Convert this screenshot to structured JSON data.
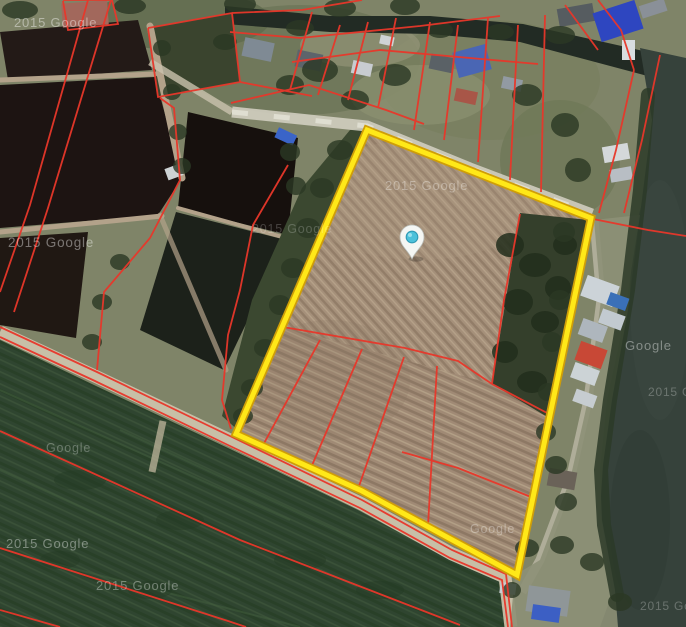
{
  "map": {
    "description": "satellite-map-with-parcel-overlay",
    "provider_watermarks": [
      {
        "text": "2015 Google",
        "x": 14,
        "y": 27,
        "size": 13,
        "opacity": 0.42
      },
      {
        "text": "2015 Google",
        "x": 8,
        "y": 247,
        "size": 13.5,
        "opacity": 0.4
      },
      {
        "text": "2015 Google",
        "x": 252,
        "y": 233,
        "size": 12.5,
        "opacity": 0.2
      },
      {
        "text": "2015 Google",
        "x": 385,
        "y": 190,
        "size": 13,
        "opacity": 0.32
      },
      {
        "text": "Google",
        "x": 625,
        "y": 350,
        "size": 13,
        "opacity": 0.38
      },
      {
        "text": "Google",
        "x": 46,
        "y": 452,
        "size": 12.5,
        "opacity": 0.28
      },
      {
        "text": "2015 Google",
        "x": 6,
        "y": 548,
        "size": 13,
        "opacity": 0.38
      },
      {
        "text": "2015 Google",
        "x": 96,
        "y": 590,
        "size": 13,
        "opacity": 0.34
      },
      {
        "text": "Google",
        "x": 470,
        "y": 533,
        "size": 12.5,
        "opacity": 0.3
      },
      {
        "text": "2015 Goo",
        "x": 648,
        "y": 396,
        "size": 12,
        "opacity": 0.25
      },
      {
        "text": "2015 Google",
        "x": 640,
        "y": 610,
        "size": 12,
        "opacity": 0.25
      }
    ],
    "pin": {
      "x": 412,
      "y": 259,
      "balloon_color": "#f4f6f3",
      "dot_color": "#4cc1da"
    },
    "highlight_parcel": {
      "points": "367,130 591,218 549,420 517,575 362,491 236,434",
      "core_color": "#ffe818",
      "edge_color": "#cf9e08",
      "core_width": 5,
      "edge_width": 8.5
    },
    "cadastral_lines": {
      "color": "#e8372a",
      "width": 1.8,
      "paths": [
        "88,0 30,205 0,292",
        "111,0 48,208 14,312",
        "63,0 112,0 118,24 68,30 63,1",
        "148,28 232,13 240,82 158,97 148,28",
        "240,82 312,96",
        "232,13 302,10 362,0",
        "160,98 174,108 180,180 150,238 104,292 97,370",
        "288,165 253,225 240,290 228,335 222,400 231,429",
        "230,32 300,38 420,26 500,16",
        "231,103 309,85 386,110 424,124",
        "312,12 290,90",
        "340,25 318,95",
        "368,22 348,100",
        "396,18 378,108",
        "430,22 414,130",
        "458,25 444,140",
        "488,18 478,162",
        "518,25 510,180",
        "545,15 541,192",
        "292,62 380,50 470,58 538,64",
        "565,5 598,50",
        "598,0 621,30 634,70",
        "634,70 616,150 599,213",
        "660,55 642,140 624,213",
        "593,219 648,230 686,236",
        "283,327 405,348 458,361 492,384",
        "520,214 504,300 492,384",
        "492,384 549,414",
        "320,340 262,447",
        "362,349 310,470",
        "404,357 358,489",
        "437,366 428,526",
        "402,452 458,468 531,497",
        "0,327 97,372 232,437 362,500 452,550 506,574 512,627",
        "0,337 95,381 230,446 360,508 450,558 502,580 508,627",
        "0,431 240,540 460,625",
        "0,548 228,621 246,627",
        "0,610 60,627"
      ]
    },
    "colors": {
      "parcel_highlight": "#ffe818",
      "cadastral_red": "#e8372a",
      "pin_dot_teal": "#4cc1da",
      "water_dark": "#1d1412",
      "river": "#36423b",
      "plowed_field": "#a5907b",
      "rice_field": "#2f4530"
    }
  }
}
